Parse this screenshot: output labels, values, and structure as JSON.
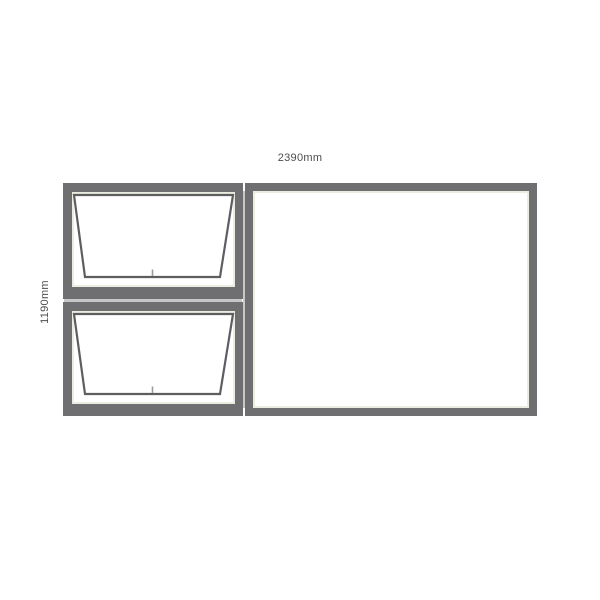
{
  "diagram": {
    "type": "window-elevation-drawing",
    "dimensions": {
      "width_label": "2390mm",
      "height_label": "1190mm"
    },
    "colors": {
      "background": "#ffffff",
      "frame": "#6f6f71",
      "sash_outline": "#5e5e61",
      "glass": "#ffffff",
      "glass_edge": "#e9eee1",
      "seam": "#c6c8c8",
      "handle_tick": "#989e96",
      "label_text": "#4d4d4f"
    },
    "panels": [
      {
        "id": "top-left",
        "type": "awning",
        "state": "open-projection",
        "handle": "bottom-center"
      },
      {
        "id": "bottom-left",
        "type": "awning",
        "state": "open-projection",
        "handle": "bottom-center"
      },
      {
        "id": "right",
        "type": "fixed",
        "state": "closed"
      }
    ]
  }
}
